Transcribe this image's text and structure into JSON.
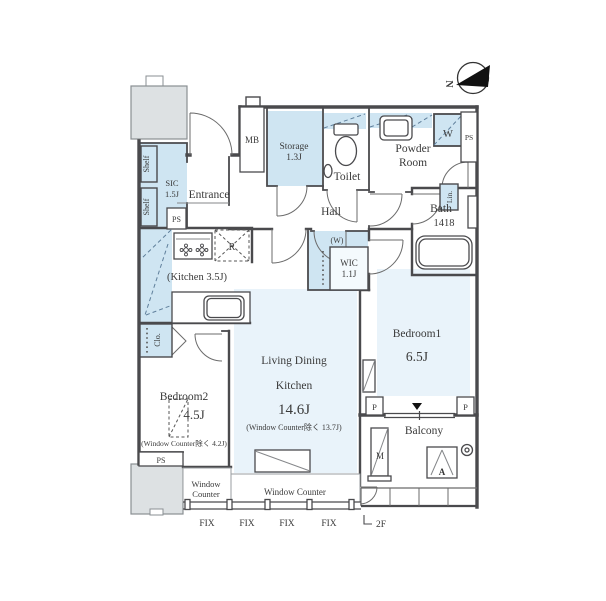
{
  "colors": {
    "wall": "#4a4a4d",
    "cabinet_fill": "#cfe5f2",
    "room_fill": "#e9f3fa",
    "corridor_gray": "#dde1e3"
  },
  "compass": {
    "north": "N"
  },
  "rooms": {
    "entrance": {
      "label": "Entrance"
    },
    "sic": {
      "name": "SIC",
      "size": "1.5J"
    },
    "hall": {
      "label": "Hall"
    },
    "storage": {
      "name": "Storage",
      "size": "1.3J"
    },
    "toilet": {
      "label": "Toilet"
    },
    "powder_room": {
      "line1": "Powder",
      "line2": "Room"
    },
    "bath": {
      "name": "Bath",
      "size": "1418"
    },
    "kitchen": {
      "label": "(Kitchen 3.5J)"
    },
    "wic": {
      "name": "WIC",
      "size": "1.1J",
      "hanger_note": "(W)"
    },
    "ldk": {
      "line1": "Living Dining",
      "line2": "Kitchen",
      "size": "14.6J",
      "note": "(Window Counter除く 13.7J)"
    },
    "bedroom1": {
      "name": "Bedroom1",
      "size": "6.5J"
    },
    "bedroom2": {
      "name": "Bedroom2",
      "size": "4.5J",
      "note": "(Window Counter除く 4.2J)"
    },
    "balcony": {
      "label": "Balcony"
    }
  },
  "closets": {
    "shelf_upper": "Shelf",
    "shelf_lower": "Shelf",
    "closet": "Clo.",
    "linen": "Lin."
  },
  "shafts": {
    "ps_entrance": "PS",
    "ps_powder": "PS",
    "ps_bedroom2": "PS",
    "meter_box": "MB",
    "pipe_left": "P",
    "pipe_right": "P"
  },
  "appliances": {
    "washer": "W",
    "refrigerator": "R",
    "meter": "M",
    "aircon": "A"
  },
  "windows": {
    "counter_small": {
      "line1": "Window",
      "line2": "Counter"
    },
    "counter_main": "Window Counter",
    "fix": [
      "FIX",
      "FIX",
      "FIX",
      "FIX"
    ],
    "floor_tag": "2F"
  }
}
